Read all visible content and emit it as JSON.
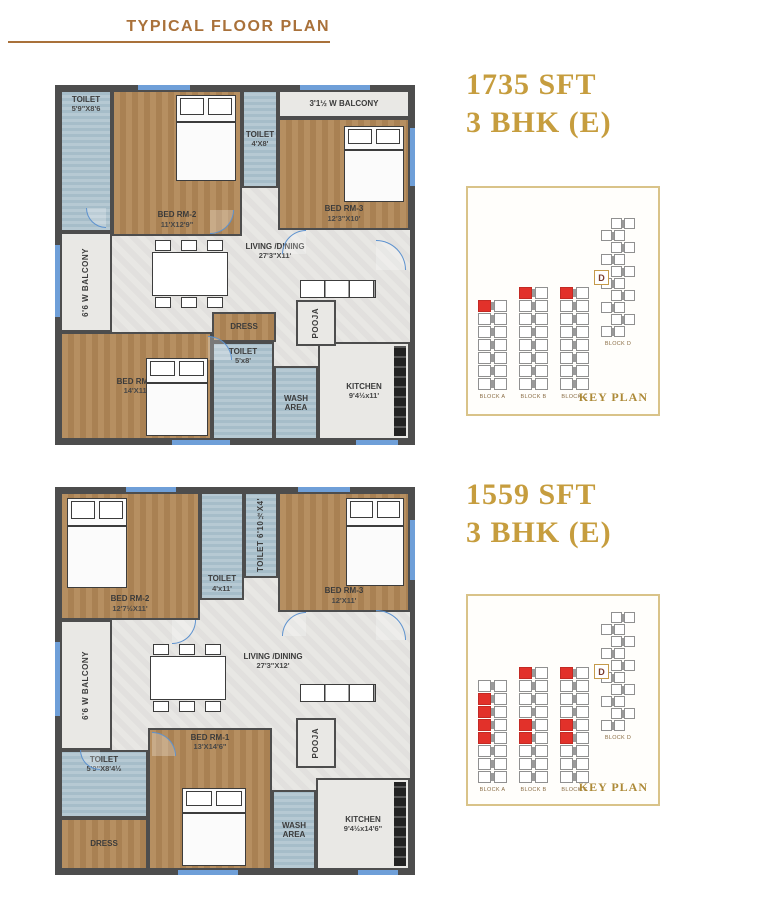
{
  "page": {
    "title": "TYPICAL FLOOR PLAN"
  },
  "units": [
    {
      "area": "1735 SFT",
      "bhk": "3 BHK (E)",
      "rooms": {
        "toilet_tl": {
          "name": "TOILET",
          "dims": "5'9\"X8'6"
        },
        "bedrm2": {
          "name": "BED RM-2",
          "dims": "11'X12'9\""
        },
        "toilet_mid": {
          "name": "TOILET",
          "dims": "4'X8'"
        },
        "balcony_top": {
          "name": "3'1½ W BALCONY"
        },
        "bedrm3": {
          "name": "BED RM-3",
          "dims": "12'3\"X10'"
        },
        "balcony_left": {
          "name": "6'6 W BALCONY"
        },
        "living": {
          "name": "LIVING /DINING",
          "dims": "27'3\"X11'"
        },
        "pooja": {
          "name": "POOJA"
        },
        "bedrm1": {
          "name": "BED RM-1",
          "dims": "14'X11'"
        },
        "dress": {
          "name": "DRESS"
        },
        "toilet_b": {
          "name": "TOILET",
          "dims": "5'x8'"
        },
        "wash": {
          "name": "WASH AREA"
        },
        "kitchen": {
          "name": "KITCHEN",
          "dims": "9'4½x11'"
        }
      },
      "keyplan": {
        "caption": "KEY PLAN",
        "blocks": [
          {
            "label": "BLOCK A",
            "rows": 7,
            "red": [
              0
            ]
          },
          {
            "label": "BLOCK B",
            "rows": 8,
            "red": [
              0
            ]
          },
          {
            "label": "BLOCK C",
            "rows": 8,
            "red": [
              0
            ]
          },
          {
            "label": "BLOCK D",
            "rows": 10,
            "red": [],
            "d": "D"
          }
        ]
      }
    },
    {
      "area": "1559 SFT",
      "bhk": "3 BHK (E)",
      "rooms": {
        "bedrm2": {
          "name": "BED RM-2",
          "dims": "12'7½X11'"
        },
        "toilet_a": {
          "name": "TOILET",
          "dims": "4'x11'"
        },
        "toilet_v": {
          "name": "TOILET 6'10½X4'"
        },
        "bedrm3": {
          "name": "BED RM-3",
          "dims": "12'X11'"
        },
        "balcony_left": {
          "name": "6'6 W BALCONY"
        },
        "living": {
          "name": "LIVING /DINING",
          "dims": "27'3\"X12'"
        },
        "pooja": {
          "name": "POOJA"
        },
        "toilet_bl": {
          "name": "TOILET",
          "dims": "5'9\"X8'4½"
        },
        "dress": {
          "name": "DRESS"
        },
        "bedrm1": {
          "name": "BED RM-1",
          "dims": "13'X14'6\""
        },
        "wash": {
          "name": "WASH AREA"
        },
        "kitchen": {
          "name": "KITCHEN",
          "dims": "9'4½x14'6\""
        }
      },
      "keyplan": {
        "caption": "KEY PLAN",
        "blocks": [
          {
            "label": "BLOCK A",
            "rows": 8,
            "red": [
              1,
              2,
              3,
              4
            ]
          },
          {
            "label": "BLOCK B",
            "rows": 9,
            "red": [
              0,
              4,
              5
            ]
          },
          {
            "label": "BLOCK C",
            "rows": 9,
            "red": [
              0,
              4,
              5
            ]
          },
          {
            "label": "BLOCK D",
            "rows": 10,
            "red": [],
            "d": "D"
          }
        ]
      }
    }
  ]
}
